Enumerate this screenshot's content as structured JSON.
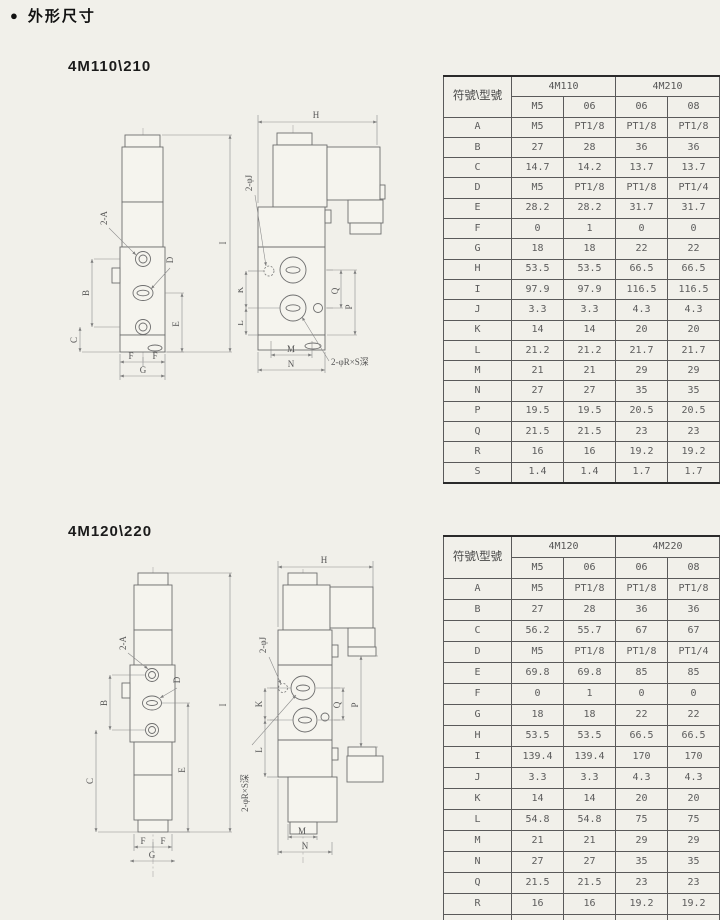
{
  "header": {
    "bullet": "●",
    "title": "外形尺寸"
  },
  "dim_labels": {
    "h": "H",
    "i": "I",
    "b": "B",
    "c": "C",
    "e": "E",
    "f": "F",
    "g": "G",
    "k": "K",
    "l": "L",
    "m": "M",
    "n": "N",
    "p": "P",
    "q": "Q",
    "port_a": "2-A",
    "port_d": "D",
    "hole_j": "2-φJ",
    "hole_r": "2-φR×S深"
  },
  "sections": [
    {
      "title": "4M110\\210",
      "table": {
        "corner": "符號\\型號",
        "groups": [
          "4M110",
          "4M210"
        ],
        "subcols": [
          "M5",
          "06",
          "06",
          "08"
        ],
        "rows": [
          {
            "sym": "A",
            "values": [
              "M5",
              "PT1/8",
              "PT1/8",
              "PT1/8"
            ]
          },
          {
            "sym": "B",
            "values": [
              "27",
              "28",
              "36",
              "36"
            ]
          },
          {
            "sym": "C",
            "values": [
              "14.7",
              "14.2",
              "13.7",
              "13.7"
            ]
          },
          {
            "sym": "D",
            "values": [
              "M5",
              "PT1/8",
              "PT1/8",
              "PT1/4"
            ]
          },
          {
            "sym": "E",
            "values": [
              "28.2",
              "28.2",
              "31.7",
              "31.7"
            ]
          },
          {
            "sym": "F",
            "values": [
              "0",
              "1",
              "0",
              "0"
            ]
          },
          {
            "sym": "G",
            "values": [
              "18",
              "18",
              "22",
              "22"
            ]
          },
          {
            "sym": "H",
            "values": [
              "53.5",
              "53.5",
              "66.5",
              "66.5"
            ]
          },
          {
            "sym": "I",
            "values": [
              "97.9",
              "97.9",
              "116.5",
              "116.5"
            ]
          },
          {
            "sym": "J",
            "values": [
              "3.3",
              "3.3",
              "4.3",
              "4.3"
            ]
          },
          {
            "sym": "K",
            "values": [
              "14",
              "14",
              "20",
              "20"
            ]
          },
          {
            "sym": "L",
            "values": [
              "21.2",
              "21.2",
              "21.7",
              "21.7"
            ]
          },
          {
            "sym": "M",
            "values": [
              "21",
              "21",
              "29",
              "29"
            ]
          },
          {
            "sym": "N",
            "values": [
              "27",
              "27",
              "35",
              "35"
            ]
          },
          {
            "sym": "P",
            "values": [
              "19.5",
              "19.5",
              "20.5",
              "20.5"
            ]
          },
          {
            "sym": "Q",
            "values": [
              "21.5",
              "21.5",
              "23",
              "23"
            ]
          },
          {
            "sym": "R",
            "values": [
              "16",
              "16",
              "19.2",
              "19.2"
            ]
          },
          {
            "sym": "S",
            "values": [
              "1.4",
              "1.4",
              "1.7",
              "1.7"
            ]
          }
        ]
      }
    },
    {
      "title": "4M120\\220",
      "table": {
        "corner": "符號\\型號",
        "groups": [
          "4M120",
          "4M220"
        ],
        "subcols": [
          "M5",
          "06",
          "06",
          "08"
        ],
        "rows": [
          {
            "sym": "A",
            "values": [
              "M5",
              "PT1/8",
              "PT1/8",
              "PT1/8"
            ]
          },
          {
            "sym": "B",
            "values": [
              "27",
              "28",
              "36",
              "36"
            ]
          },
          {
            "sym": "C",
            "values": [
              "56.2",
              "55.7",
              "67",
              "67"
            ]
          },
          {
            "sym": "D",
            "values": [
              "M5",
              "PT1/8",
              "PT1/8",
              "PT1/4"
            ]
          },
          {
            "sym": "E",
            "values": [
              "69.8",
              "69.8",
              "85",
              "85"
            ]
          },
          {
            "sym": "F",
            "values": [
              "0",
              "1",
              "0",
              "0"
            ]
          },
          {
            "sym": "G",
            "values": [
              "18",
              "18",
              "22",
              "22"
            ]
          },
          {
            "sym": "H",
            "values": [
              "53.5",
              "53.5",
              "66.5",
              "66.5"
            ]
          },
          {
            "sym": "I",
            "values": [
              "139.4",
              "139.4",
              "170",
              "170"
            ]
          },
          {
            "sym": "J",
            "values": [
              "3.3",
              "3.3",
              "4.3",
              "4.3"
            ]
          },
          {
            "sym": "K",
            "values": [
              "14",
              "14",
              "20",
              "20"
            ]
          },
          {
            "sym": "L",
            "values": [
              "54.8",
              "54.8",
              "75",
              "75"
            ]
          },
          {
            "sym": "M",
            "values": [
              "21",
              "21",
              "29",
              "29"
            ]
          },
          {
            "sym": "N",
            "values": [
              "27",
              "27",
              "35",
              "35"
            ]
          },
          {
            "sym": "Q",
            "values": [
              "21.5",
              "21.5",
              "23",
              "23"
            ]
          },
          {
            "sym": "R",
            "values": [
              "16",
              "16",
              "19.2",
              "19.2"
            ]
          },
          {
            "sym": "S",
            "values": [
              "1.4",
              "1.4",
              "1.7",
              "1.7"
            ]
          }
        ]
      }
    }
  ]
}
